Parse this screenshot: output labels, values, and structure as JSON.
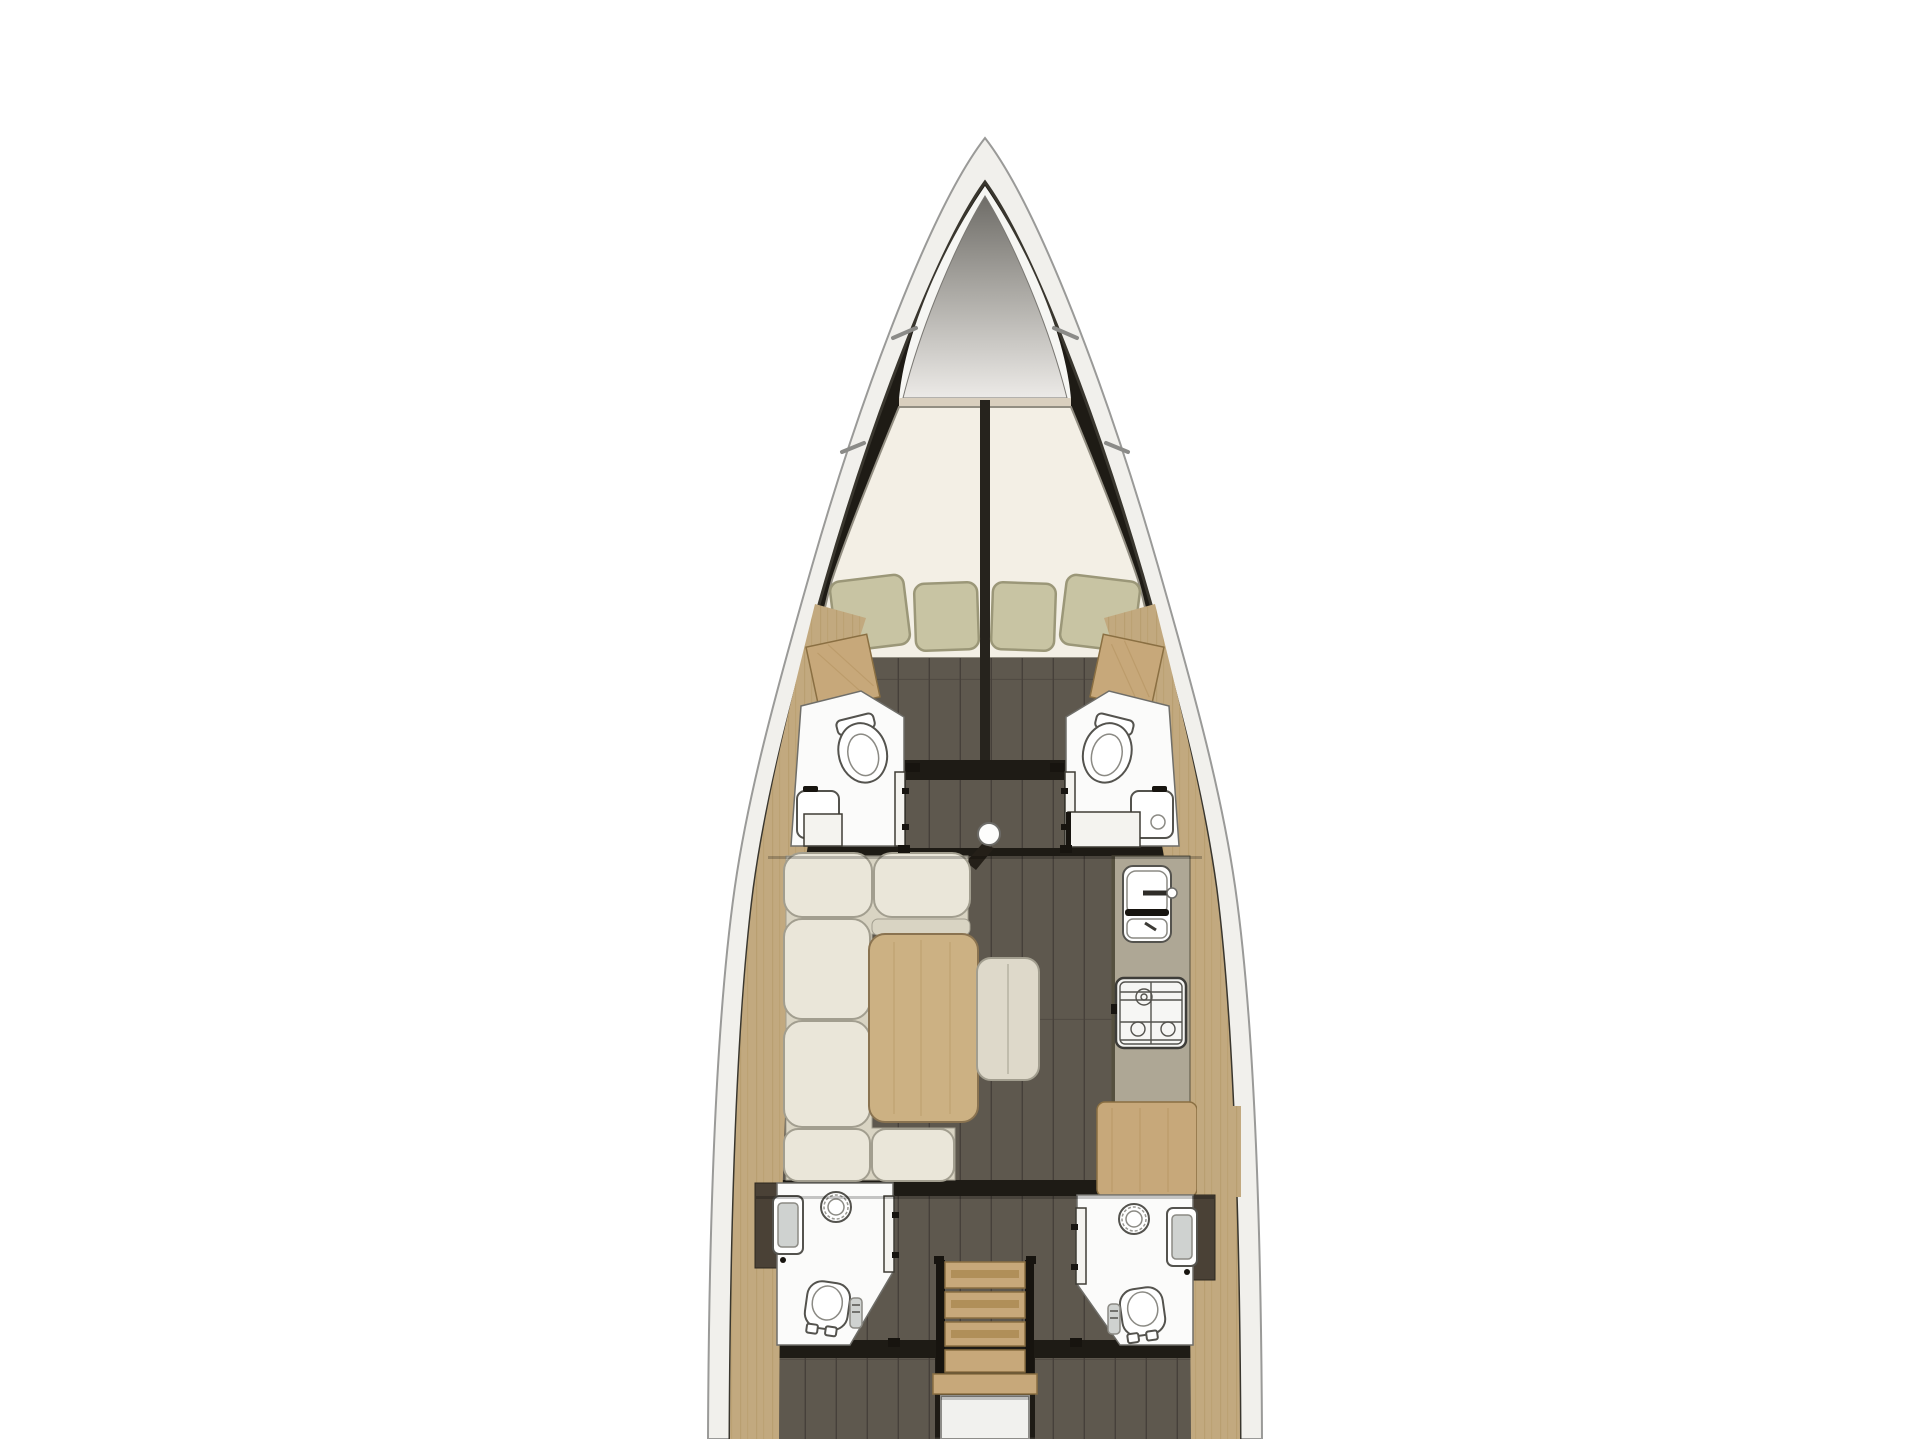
{
  "meta": {
    "title": "Sailing yacht interior floor plan, top view, bow up",
    "type": "yacht-floorplan",
    "orientation": "bow-up",
    "visible_text": "none"
  },
  "colors": {
    "background": "#ffffff",
    "hull_band": "#f1f0ec",
    "hull_outline": "#9a9a98",
    "hull_inner": "#39362e",
    "interior": "#1e1b15",
    "forepeak": "#f6f6f3",
    "cone_top": "#6e6c67",
    "cone_mid": "#a8a6a1",
    "cone_low": "#eceae7",
    "shelf_strip": "#d9cfbe",
    "mattress": "#f3efe5",
    "mattress_edge": "#928e82",
    "divider": "#26231d",
    "pillow": "#c8c4a3",
    "pillow_edge": "#9b9778",
    "floor": "#5e584e",
    "floor_seam": "#46403a",
    "wood": "#c7a87a",
    "wood_grain": "#a8874f",
    "wood_dark": "#8a6f42",
    "wood_band": "#c2a97f",
    "bath": "#fbfbfa",
    "bath_edge": "#6f6e69",
    "fixture": "#54534e",
    "fixture_soft": "#8b8a84",
    "door": "#f4f3ef",
    "door_edge": "#3f3c35",
    "counter": "#aea795",
    "counter_edge": "#55503f",
    "cushion": "#eae6d9",
    "cushion_edge": "#a29e8f",
    "cushion_base": "#d9d4c3",
    "table": "#ccb183",
    "table_edge": "#8a7350",
    "ottoman": "#ded9ca",
    "stove": "#f6f6f4",
    "stove_line": "#3e3d39",
    "cabinet_dark": "#4a4136",
    "shower_glass": "#cfd2d0",
    "engine": "#f1f1ee",
    "hardware": "#17140f"
  },
  "regions": [
    {
      "id": "anchor-locker",
      "kind": "sail-locker"
    },
    {
      "id": "v-berth-cabin",
      "kind": "double-berth",
      "pillows": 4
    },
    {
      "id": "port-forward-head",
      "kind": "bathroom",
      "fixtures": [
        "toilet",
        "sink",
        "door"
      ]
    },
    {
      "id": "starboard-forward-head",
      "kind": "bathroom",
      "fixtures": [
        "toilet",
        "sink",
        "door"
      ]
    },
    {
      "id": "saloon",
      "kind": "salon",
      "furniture": [
        "c-shaped-sofa",
        "dining-table",
        "ottoman",
        "mast-post"
      ]
    },
    {
      "id": "galley",
      "kind": "kitchen",
      "fixtures": [
        "double-sink",
        "stove"
      ]
    },
    {
      "id": "chart-table",
      "kind": "nav-station"
    },
    {
      "id": "port-aft-head",
      "kind": "bathroom",
      "fixtures": [
        "shower",
        "round-sink",
        "toilet",
        "door"
      ]
    },
    {
      "id": "starboard-aft-head",
      "kind": "bathroom",
      "fixtures": [
        "shower",
        "round-sink",
        "toilet",
        "door"
      ]
    },
    {
      "id": "companionway",
      "kind": "stairs",
      "treads": 5
    },
    {
      "id": "engine-compartment",
      "kind": "engine-box"
    },
    {
      "id": "port-aft-cabin",
      "kind": "cabin"
    },
    {
      "id": "starboard-aft-cabin",
      "kind": "cabin"
    }
  ]
}
